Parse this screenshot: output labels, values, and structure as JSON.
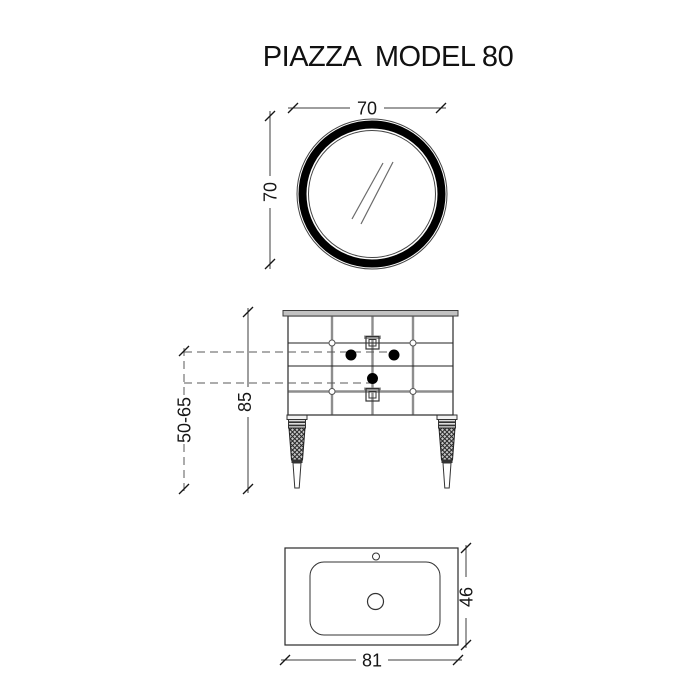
{
  "title": "PIAZZA  MODEL 80",
  "dimensions": {
    "mirror_width": "70",
    "mirror_height": "70",
    "vanity_height": "85",
    "mixer_height_range": "50-65",
    "basin_width": "81",
    "basin_depth": "46"
  },
  "colors": {
    "line": "#1f1f1f",
    "gray_line": "#8e8e8e",
    "countertop_fill": "#c2c2c2",
    "mirror_frame": "#000000",
    "background": "#ffffff"
  }
}
